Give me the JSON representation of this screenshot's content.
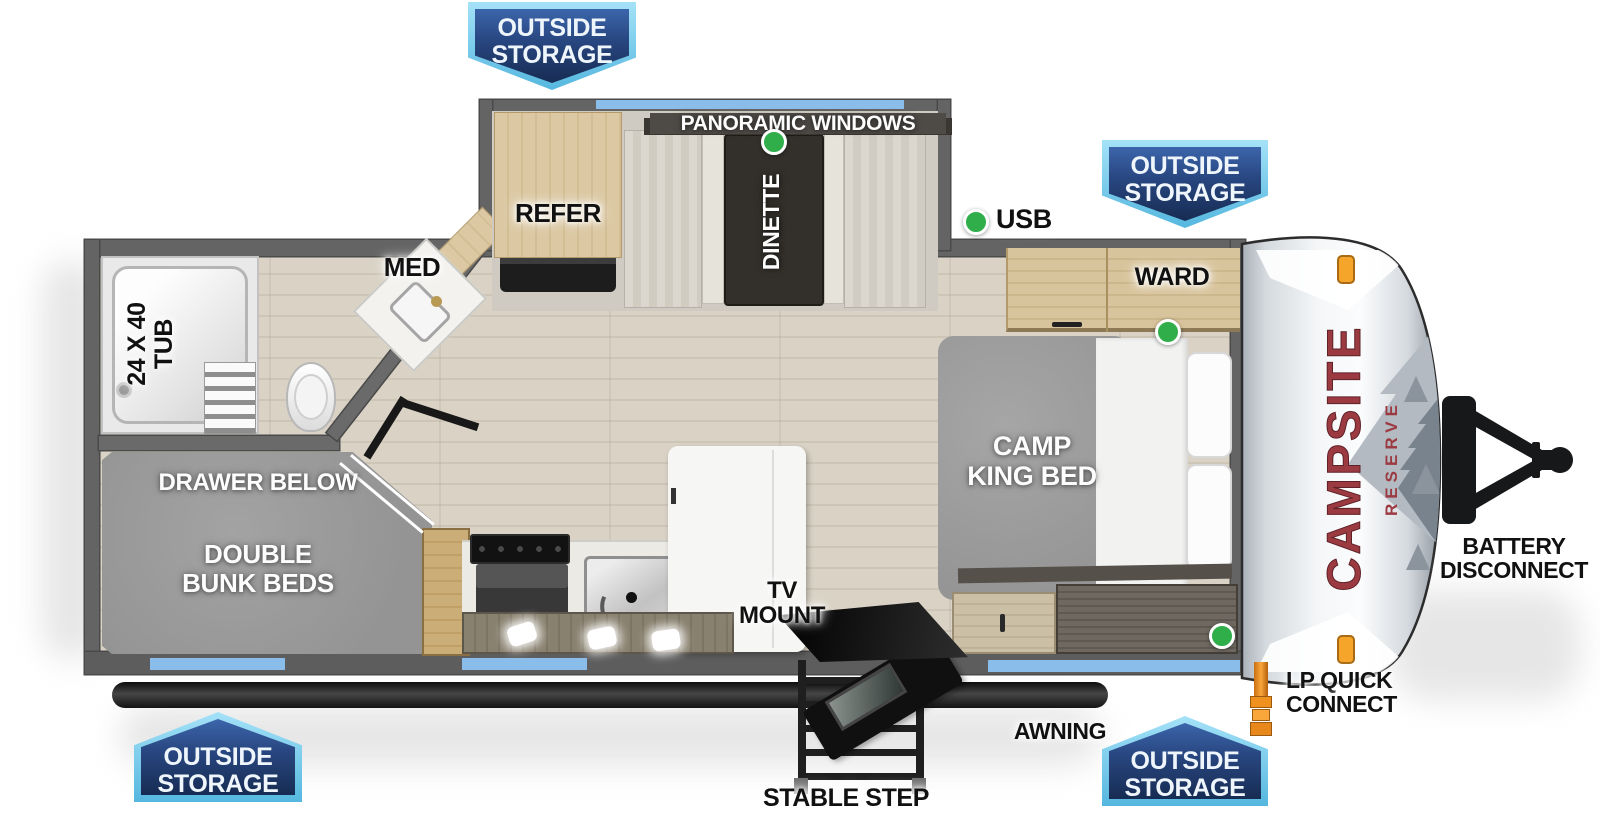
{
  "brand": {
    "name": "CAMPSITE",
    "series": "RESERVE"
  },
  "badges": {
    "line1": "OUTSIDE",
    "line2": "STORAGE"
  },
  "labels": {
    "panoramic_windows": "PANORAMIC WINDOWS",
    "refer": "REFER",
    "dinette": "DINETTE",
    "usb": "USB",
    "med": "MED",
    "ward": "WARD",
    "tub_line1": "24 X 40",
    "tub_line2": "TUB",
    "camp_king_line1": "CAMP",
    "camp_king_line2": "KING BED",
    "drawer_below": "DRAWER BELOW",
    "bunk_line1": "DOUBLE",
    "bunk_line2": "BUNK BEDS",
    "tv_line1": "TV",
    "tv_line2": "MOUNT",
    "battery_line1": "BATTERY",
    "battery_line2": "DISCONNECT",
    "lp_line1": "LP QUICK",
    "lp_line2": "CONNECT",
    "awning": "AWNING",
    "stable_step": "STABLE STEP"
  },
  "indicators": {
    "green_dot_locations": [
      "dinette-table",
      "kitchen-wall-usb",
      "bed-head-top",
      "bed-head-bottom"
    ]
  },
  "colors": {
    "badge_outer_blue": "#6fc9ec",
    "badge_inner_blue": "#24437c",
    "indicator_green": "#2fae4a",
    "window_blue": "#8abde9",
    "marker_orange": "#f5a62a",
    "brand_red": "#9c3a42",
    "wall_gray": "#646464"
  }
}
